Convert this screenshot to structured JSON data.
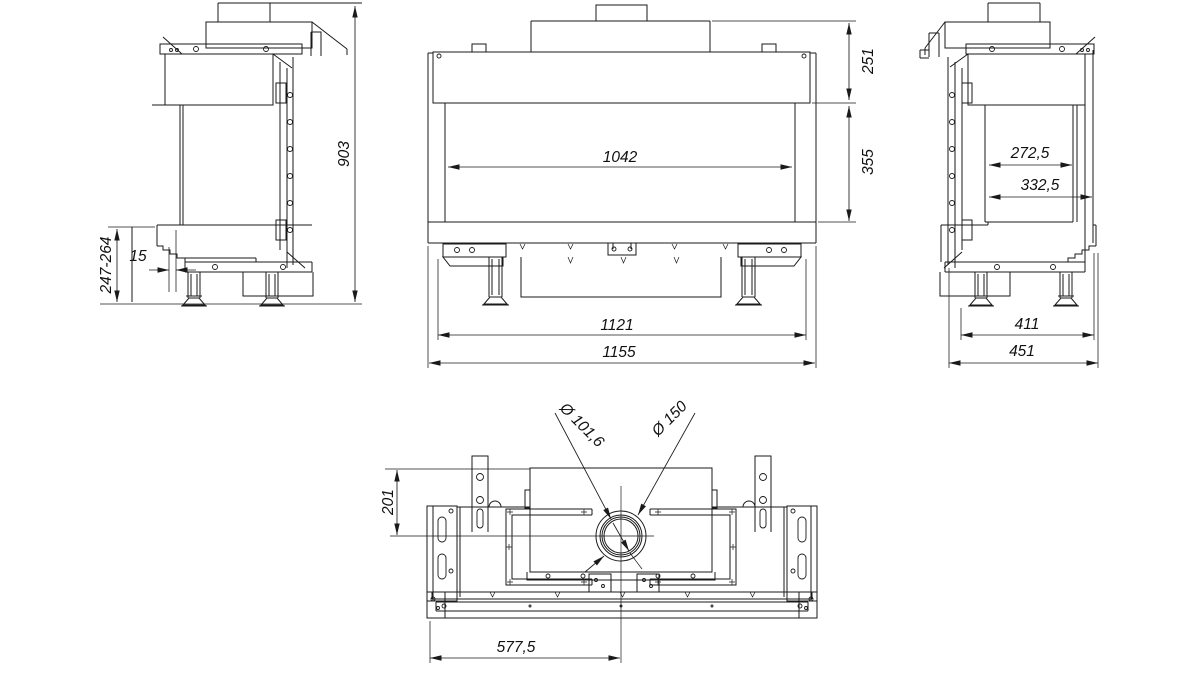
{
  "drawing": {
    "background": "#ffffff",
    "line_color": "#1a1a1a",
    "views": {
      "side_left": {
        "overall_height": "903",
        "base_height": "247-264",
        "glass_inset": "15"
      },
      "front": {
        "top_height": "251",
        "glass_height": "355",
        "glass_width": "1042",
        "inner_width": "1121",
        "overall_width": "1155"
      },
      "side_right": {
        "depth_inner": "272,5",
        "depth_glass": "332,5",
        "depth_base": "411",
        "depth_overall": "451"
      },
      "top": {
        "flue_offset_y": "201",
        "flue_d_inner": "Ø 101,6",
        "flue_d_outer": "Ø 150",
        "flue_offset_x": "577,5"
      }
    }
  }
}
